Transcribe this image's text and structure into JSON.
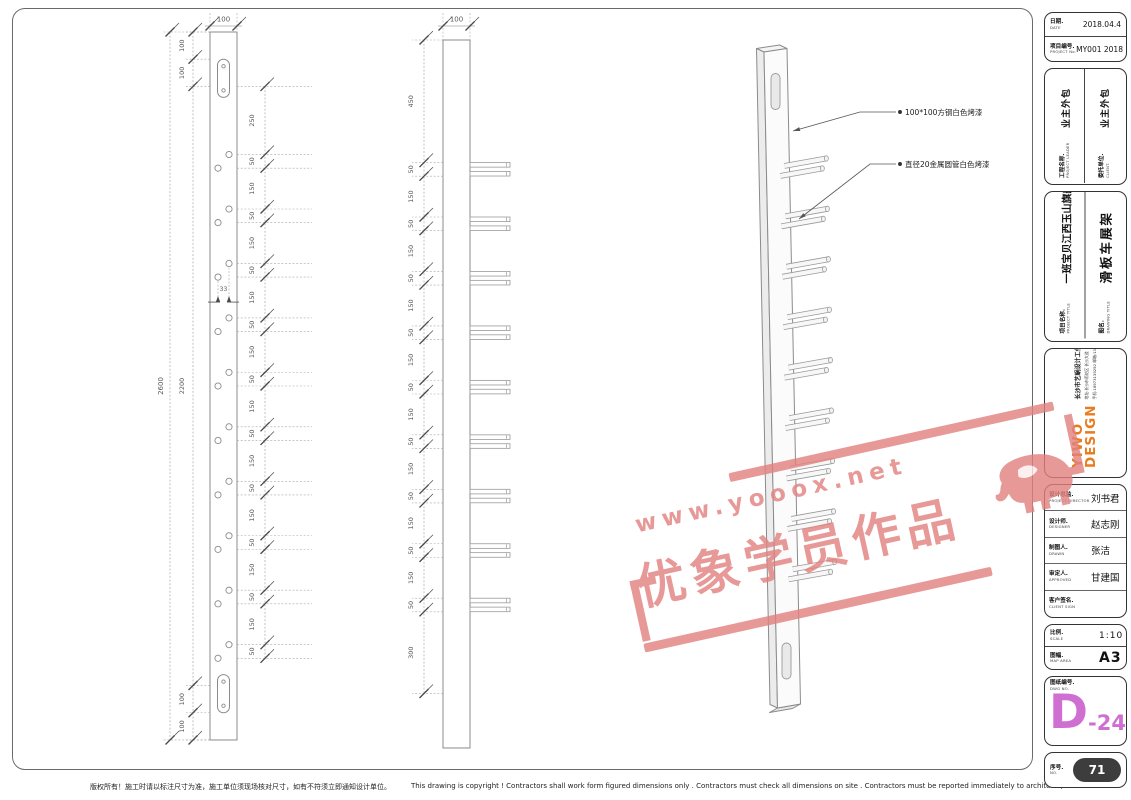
{
  "page": {
    "copyright_cn": "版权所有！施工时请以标注尺寸为准，施工单位须现场核对尺寸，如有不符须立即通知设计单位。",
    "copyright_en": "This drawing is copyright !  Contractors shall work form figured dimensions only .  Contractors must check  all dimensions on site .  Contractors must be reported immediately to architects,"
  },
  "drawing": {
    "front_view": {
      "width_label": "100",
      "left_chain_outer": [
        "2600"
      ],
      "left_chain_inner": [
        "100",
        "100",
        "2200",
        "100",
        "100"
      ],
      "right_dims": [
        "250",
        "50",
        "150",
        "50",
        "150",
        "50",
        "150",
        "50",
        "150",
        "50",
        "150",
        "50",
        "150",
        "50",
        "150",
        "50",
        "150",
        "50",
        "150",
        "50"
      ],
      "hole_gap_dim": "33"
    },
    "side_view": {
      "width_label": "100",
      "left_dims": [
        "450",
        "50",
        "150",
        "50",
        "150",
        "50",
        "150",
        "50",
        "150",
        "50",
        "150",
        "50",
        "150",
        "50",
        "150",
        "50",
        "150",
        "50",
        "300"
      ]
    },
    "annotations": [
      {
        "text": "100*100方钢白色烤漆"
      },
      {
        "text": "直径20金属圆管白色烤漆"
      }
    ]
  },
  "titleblock": {
    "date_label": "日期.",
    "date_en": "DATE",
    "date_value": "2018.04.4",
    "project_no_label": "项目编号.",
    "project_no_en": "PROJECT No.",
    "project_no_value": "MY001 2018",
    "project_leader_label": "工程名称.",
    "project_leader_en": "PROJECT LEADER",
    "project_leader_value": "业主外包",
    "client_label": "委托单位.",
    "client_en": "CLIENT.",
    "client_value": "业主外包",
    "project_title_label": "项目名称.",
    "project_title_en": "PROJECT TITLE",
    "project_title_value": "一班宝贝江西玉山旗舰店",
    "drawing_title_label": "图名.",
    "drawing_title_en": "DRAWING TITLE",
    "drawing_title_value": "滑板车展架",
    "logo_name": "YIWO",
    "logo_sub": "DESIGN",
    "studio_name": "长沙市艺蜗设计工作室",
    "studio_address": "地址:长沙市雨花区 长沙大道",
    "studio_contact": "手机:18973139292 邮箱:1300688502@QQ.com",
    "director_label": "设计总监.",
    "director_en": "PROJECT DIRECTOR",
    "director_value": "刘书君",
    "designer_label": "设计师.",
    "designer_en": "DESIGNER",
    "designer_value": "赵志刚",
    "drawn_label": "制图人.",
    "drawn_en": "DRAWN",
    "drawn_value": "张洁",
    "approved_label": "审定人.",
    "approved_en": "APPROVED",
    "approved_value": "甘建国",
    "client_sign_label": "客户签名.",
    "client_sign_en": "CLIENT SIGN",
    "client_sign_value": "",
    "scale_label": "比例.",
    "scale_en": "SCALE",
    "scale_value": "1:10",
    "size_label": "图幅.",
    "size_en": "MAP AREA",
    "size_value": "A3",
    "dwg_label": "图纸编号.",
    "dwg_en": "DWG NO.",
    "dwg_letter": "D",
    "dwg_number": "-24",
    "serial_label": "序号.",
    "serial_en": "NO.",
    "serial_value": "71"
  },
  "watermark": {
    "url": "www.yooox.net",
    "text": "优象学员作品",
    "color": "#e2807f"
  },
  "colors": {
    "accent_orange": "#e87c1e",
    "dwg_magenta": "#cf6fd2",
    "badge_dark": "#3d3d3d",
    "line_gray": "#8b8b8b"
  }
}
